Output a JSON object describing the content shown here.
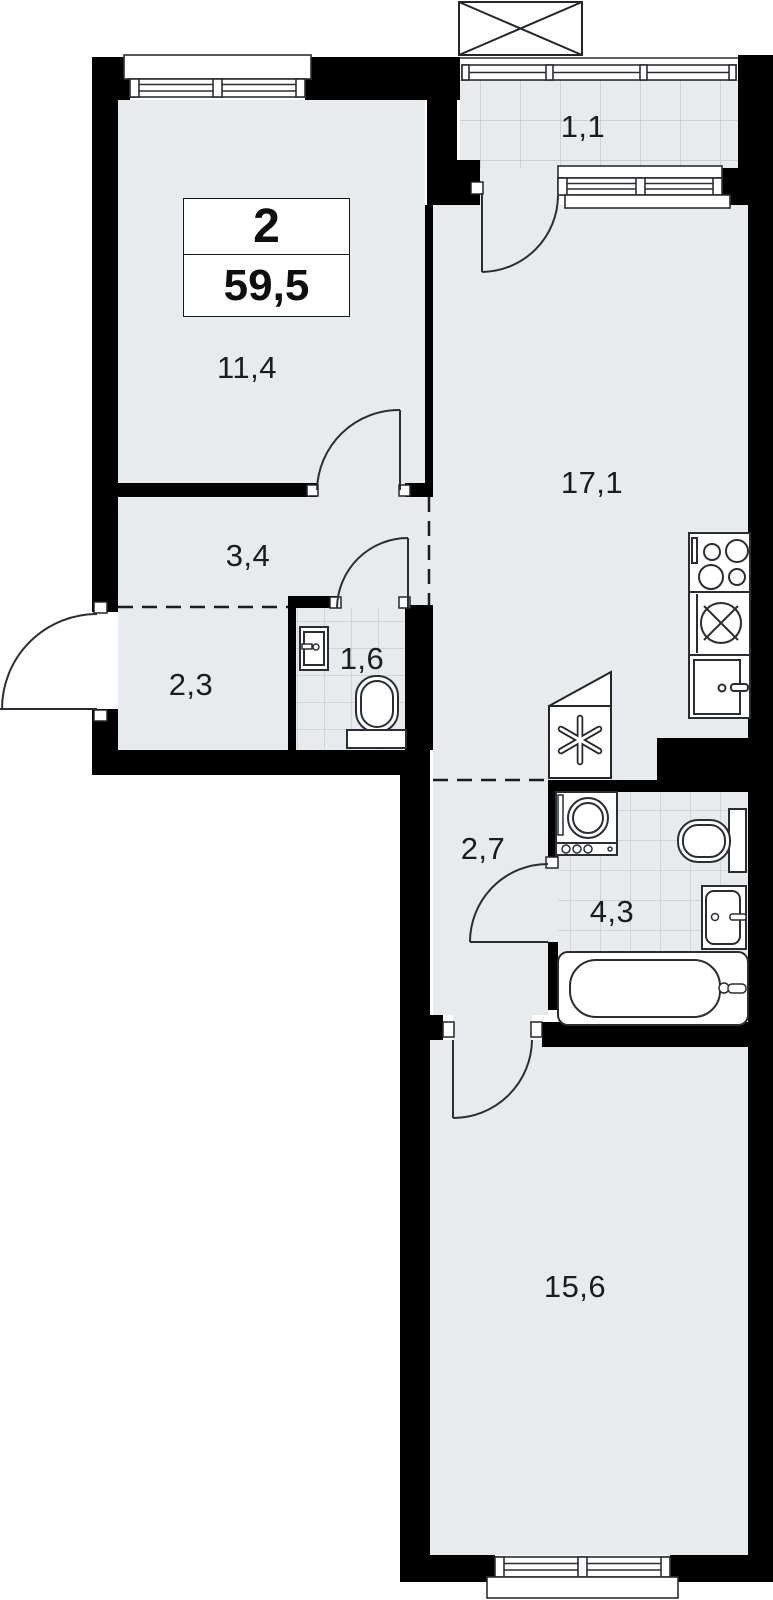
{
  "plan": {
    "info_box": {
      "rooms_count": "2",
      "total_area": "59,5"
    },
    "rooms": {
      "bedroom": {
        "area": "11,4"
      },
      "hall": {
        "area": "3,4"
      },
      "entry": {
        "area": "2,3"
      },
      "wc": {
        "area": "1,6"
      },
      "living_kitchen": {
        "area": "17,1"
      },
      "corridor": {
        "area": "2,7"
      },
      "bathroom": {
        "area": "4,3"
      },
      "bedroom2": {
        "area": "15,6"
      },
      "balcony": {
        "area": "1,1"
      }
    },
    "colors": {
      "floor": "#e8ebee",
      "wall": "#000000",
      "line": "#2a2e33",
      "tile_grid": "#c7ccd1"
    },
    "icons": [
      "stove-icon",
      "kitchen-sink-icon",
      "kitchen-cabinet-icon",
      "washing-machine-icon",
      "toilet-icon",
      "bathroom-sink-icon",
      "bathtub-icon",
      "wc-toilet-icon",
      "wc-sink-icon",
      "ventilation-icon",
      "shaft-cross-icon",
      "window-icon",
      "door-arc-icon",
      "balcony-railing-icon"
    ]
  }
}
